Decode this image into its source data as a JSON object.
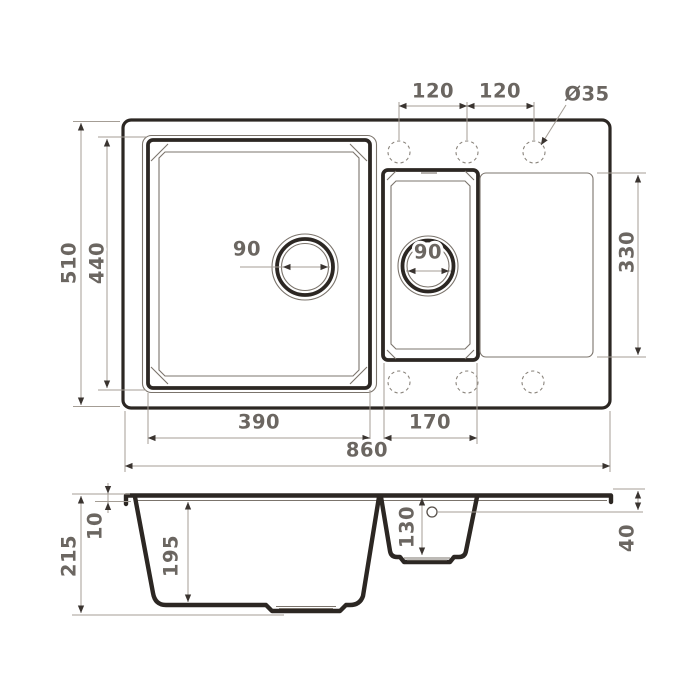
{
  "drawing": {
    "type": "sink-technical-drawing",
    "colors": {
      "outline": "#2c2723",
      "thin_line": "#7b746c",
      "dimension_line": "#a49d95",
      "dimension_text": "#6b6661",
      "background": "#ffffff"
    },
    "top_view": {
      "overall_width": "860",
      "overall_depth": "510",
      "main_bowl_width": "390",
      "main_bowl_depth": "440",
      "second_bowl_width": "170",
      "drainboard_depth": "330",
      "faucet_spacing_left": "120",
      "faucet_spacing_right": "120",
      "faucet_hole_diameter": "Ø35",
      "main_drain_diameter": "90",
      "second_drain_diameter": "90"
    },
    "side_view": {
      "overall_height": "215",
      "rim_height": "10",
      "main_bowl_depth": "195",
      "second_bowl_depth": "130",
      "right_edge_height": "40"
    }
  }
}
